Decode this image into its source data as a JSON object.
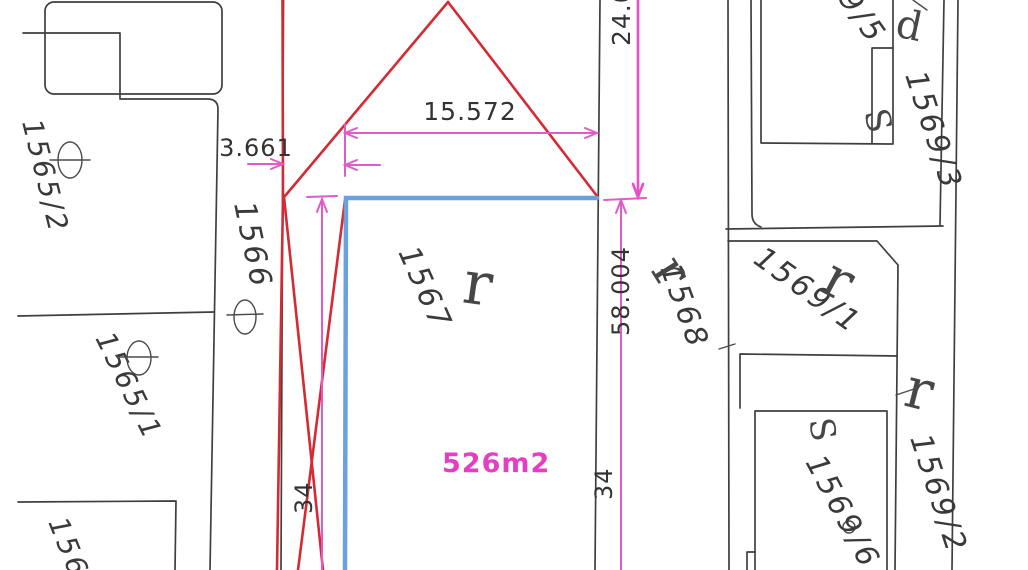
{
  "parcels": {
    "p1565_2": "1565/2",
    "p1565_1": "1565/1",
    "p156": "156",
    "p1566": "1566",
    "p1567": "1567",
    "p1568": "1568",
    "p1569_5": "1569/5",
    "p1569_3": "1569/3",
    "p1569_1": "1569/1",
    "p1569_6": "1569/6",
    "p1569_2": "1569/2"
  },
  "dimensions": {
    "width_top": "15.572",
    "offset_left": "3.661",
    "depth_right_upper": "24.0",
    "depth_right": "58.004",
    "point_left": "34",
    "point_right": "34",
    "area": "526m2"
  },
  "symbols": {
    "land_use_r": "r",
    "building_s": "S",
    "building_d": "d"
  },
  "colors": {
    "boundary_line": "#3f3f3f",
    "red_line": "#d52a33",
    "magenta_dim": "#e757c8",
    "blue_highlight": "#6ba1e0",
    "area_text": "#e33fc0",
    "dim_text": "#333333",
    "background": "#ffffff"
  }
}
